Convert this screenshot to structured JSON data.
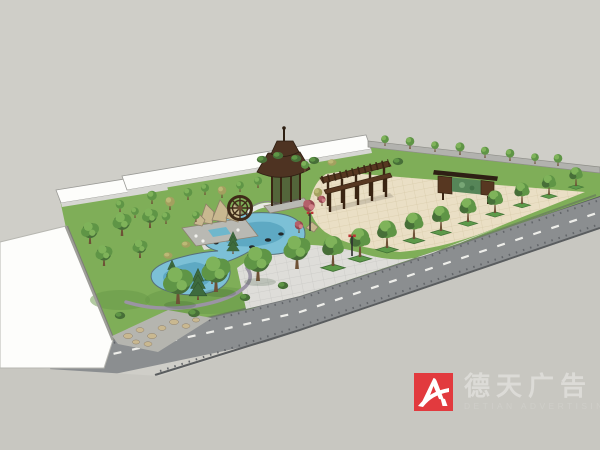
{
  "watermark": {
    "brand_cn": "德天广告",
    "brand_en": "DETIAN ADVERTISING"
  },
  "palette": {
    "bg": "#cfcec8",
    "ground": "#c8c7c1",
    "road": "#8b8e90",
    "roadEdge": "#5a5d5f",
    "curb": "#c1c1bd",
    "dash": "#eeeeea",
    "white": "#fdfdfb",
    "fascia": "#d7d7d3",
    "outline": "#9a9a96",
    "wall": "#b2b2ae",
    "lawn": "#7fae58",
    "lawnDark": "#679847",
    "walk": "#deddd9",
    "walkLine": "#c3c3bf",
    "plaza": "#eadfc5",
    "plazaLine": "#d4c6a3",
    "water": "#7cc0d6",
    "waterDeep": "#4f9cb8",
    "edging": "#9b94a4",
    "pad": "#b9b9b3",
    "pool": "#6fb7cc",
    "rock": "#c9b890",
    "rockDark": "#8f8068",
    "wood": "#573721",
    "woodDark": "#3a2513",
    "roofWood": "#4e3322",
    "mural": "#568558",
    "canopy": "#5f9546",
    "canopyDark": "#476f38",
    "canopyLight": "#7fb35a",
    "conifer": "#3e6b3d",
    "maple": "#b4606a",
    "trunk": "#6e5136",
    "planter": "#5d9a4a",
    "metal": "#2e2e2e",
    "brandRed": "#e23a3e",
    "logoText": "#dcdbd7",
    "logoSub": "#cfcec9"
  }
}
